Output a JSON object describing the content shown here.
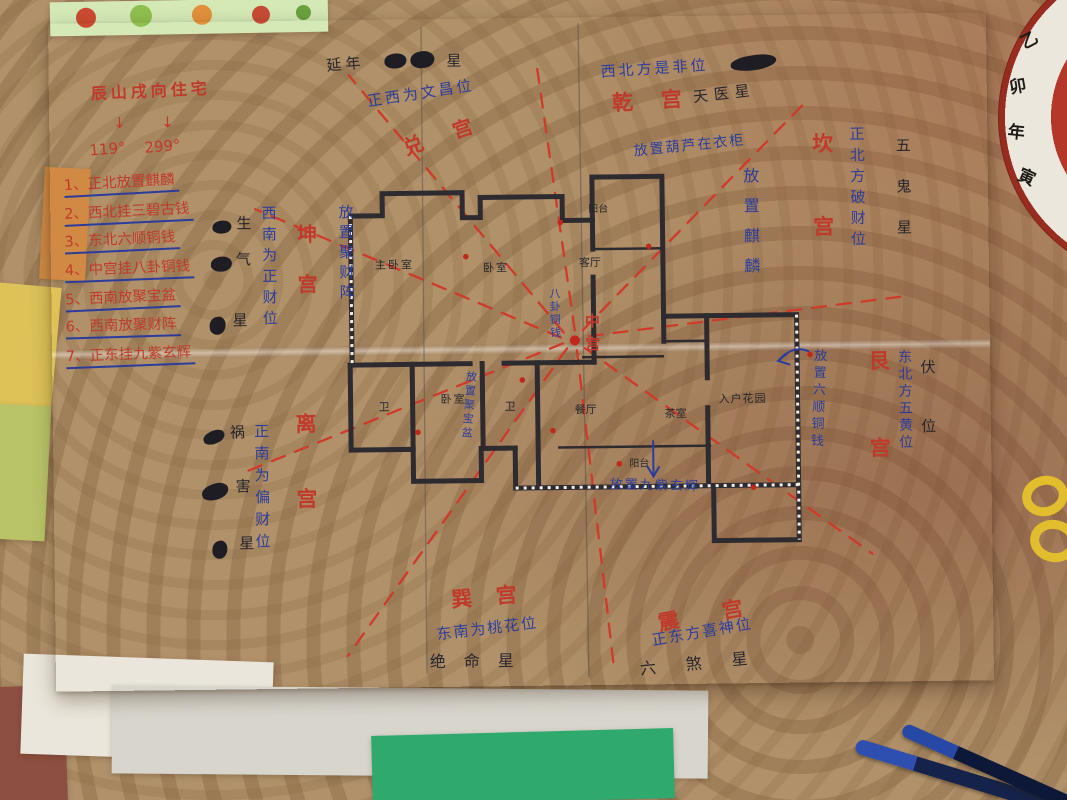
{
  "colors": {
    "red_ink": "#c03a2b",
    "blue_ink": "#2b3d9c",
    "black_ink": "#26262c",
    "dash_red": "#cf3a2a",
    "paper": "#f2efe9",
    "green_paper": "#2fa96d",
    "tablecloth": "#b0916a"
  },
  "paper": {
    "title": "辰山戌向住宅",
    "title_arrow": "↓",
    "deg_left": "119°",
    "deg_right": "299°",
    "checklist": [
      "1、正北放置麒麟",
      "2、西北挂三碧古钱",
      "3、东北六顺铜钱",
      "4、中宫挂八卦铜钱",
      "5、西南放聚宝盆",
      "6、西南放聚财阵",
      "7、正东挂九紫玄辉"
    ],
    "palaces": {
      "kun": "坤宫",
      "li": "离宫",
      "dui": "兑宫",
      "qian": "乾宫",
      "kan": "坎宫",
      "gen": "艮宫",
      "xun": "巽宫",
      "zhen": "震宫",
      "zhong": "中宫"
    },
    "notes": {
      "west": "正西为文昌位",
      "northwest": "西北方是非位",
      "southwest": "西南为正财位",
      "south": "正南为偏财位",
      "north": "正北方破财位",
      "northeast": "东北方五黄位",
      "southeast": "东南为桃花位",
      "east": "正东方喜神位"
    },
    "stars": {
      "yannian_prefix": "延年",
      "star_char": "星",
      "tianyi": "天医星",
      "wugui": "五鬼星",
      "fuwei": "伏位",
      "shengqi": [
        "生",
        "气",
        "星"
      ],
      "huohai": [
        "祸",
        "害",
        "星"
      ],
      "jueming": "绝命星",
      "liusha": "六煞星"
    },
    "placements": {
      "jucaizhen": "放置聚财阵",
      "qilin": "放置麒麟",
      "hulu": "放置葫芦在衣柜",
      "bagua_coins": "八卦铜钱",
      "jubaopen": "放置聚宝盆",
      "liushun_coins": "放置六顺铜钱",
      "jiuzi": "放置九紫玄辉"
    },
    "rooms": {
      "master_bedroom": "主卧室",
      "bedroom_top": "卧室",
      "balcony_top": "阳台",
      "living_room": "客厅",
      "bath_left": "卫",
      "bedroom_bottom": "卧室",
      "bath_mid": "卫",
      "dining_room": "餐厅",
      "tea_room": "茶室",
      "entry_garden": "入户花园",
      "balcony_bottom": "阳台"
    }
  },
  "compass": {
    "ring_chars": [
      "乙",
      "卯",
      "年",
      "寅"
    ]
  }
}
